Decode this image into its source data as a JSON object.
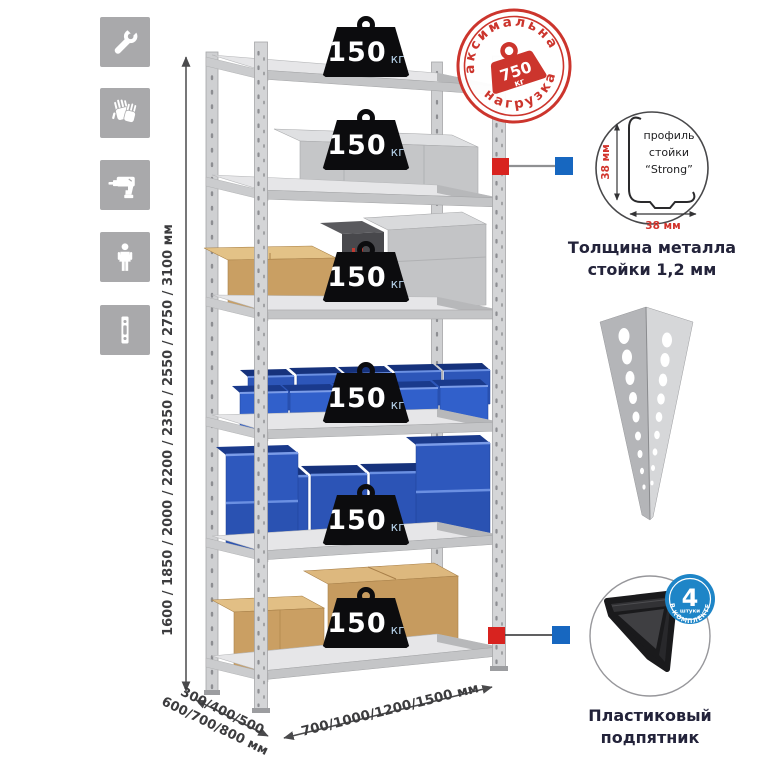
{
  "colors": {
    "accent_red": "#cc352d",
    "accent_blue": "#1767c0",
    "icon_bg": "#a9a9ab",
    "metal_light": "#e6e6e8",
    "metal_mid": "#cfd0d2",
    "bin_blue": "#2d56b9",
    "cardboard": "#c99f63",
    "text_dark": "#23233a",
    "dim_text": "#3c3c3e",
    "badge_blue": "#1e85c7"
  },
  "left_icons": [
    {
      "name": "wrench-icon"
    },
    {
      "name": "gloves-icon"
    },
    {
      "name": "drill-icon"
    },
    {
      "name": "person-icon"
    },
    {
      "name": "post-profile-icon"
    }
  ],
  "dimensions": {
    "height_label": "1600 / 1850 / 2000 / 2200 / 2350 / 2550 / 2750 / 3100 мм",
    "depth_label_line1": "300/400/500",
    "depth_label_line2": "600/700/800 мм",
    "width_label": "700/1000/1200/1500 мм"
  },
  "shelf": {
    "levels": 6,
    "load_value": "150",
    "load_unit": "кг"
  },
  "max_load_stamp": {
    "arc_top": "максимальная",
    "arc_bottom": "нагрузка",
    "value": "750",
    "unit": "кг"
  },
  "profile_detail": {
    "label_line1": "профиль",
    "label_line2": "стойки",
    "label_line3": "“Strong”",
    "dim_vertical": "38 мм",
    "dim_horizontal": "38 мм",
    "caption_line1": "Толщина металла",
    "caption_line2": "стойки 1,2 мм"
  },
  "foot_detail": {
    "badge_value": "4",
    "badge_sub": "штуки",
    "badge_arc": "В КОМПЛЕКТЕ",
    "caption_line1": "Пластиковый",
    "caption_line2": "подпятник"
  }
}
